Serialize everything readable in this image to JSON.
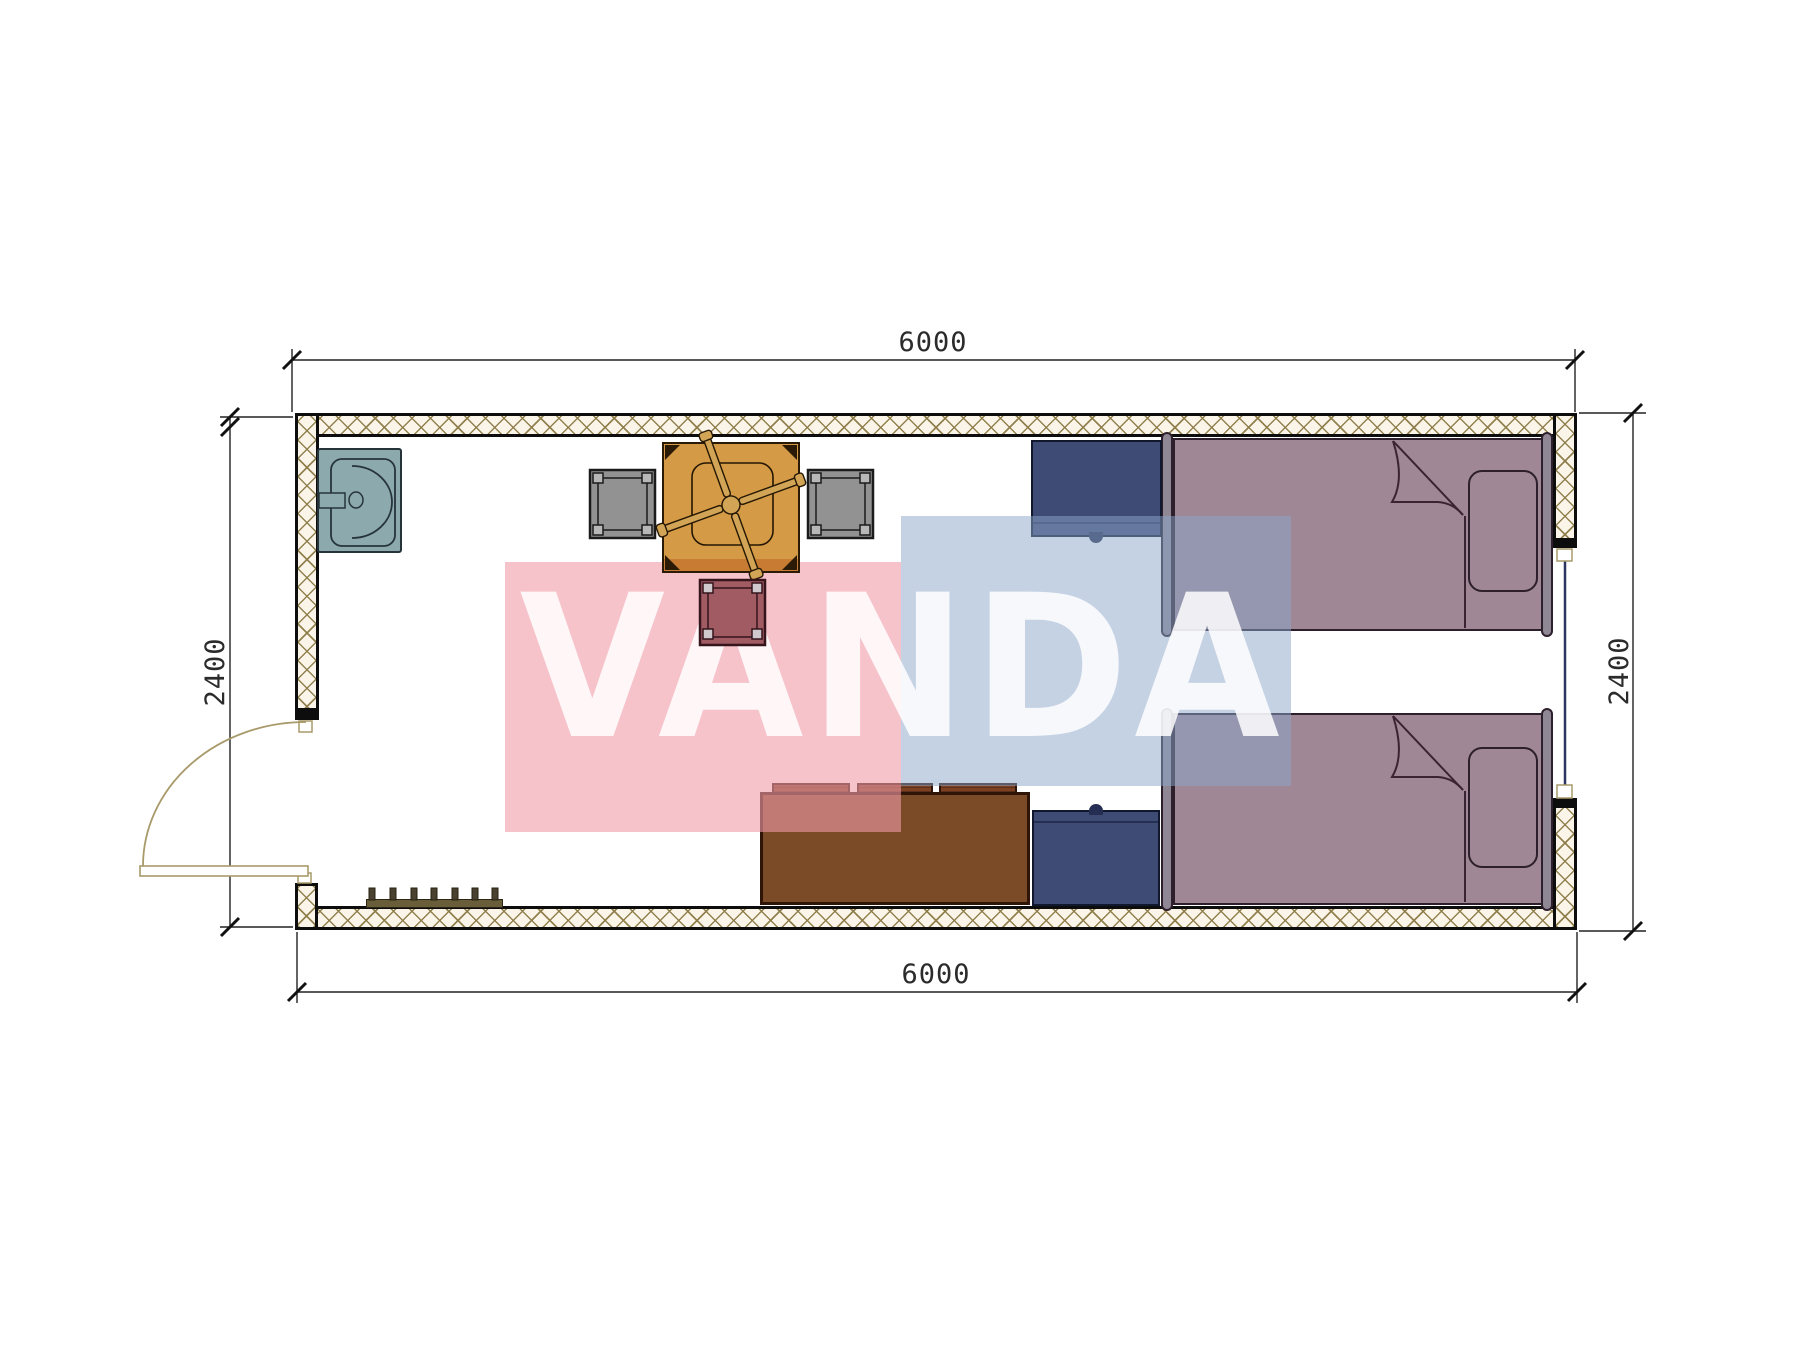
{
  "dimensions": {
    "top": "6000",
    "bottom": "6000",
    "left": "2400",
    "right": "2400"
  },
  "watermark": {
    "text": "VANDA",
    "pink": "#f29ba8",
    "blue": "#8ba5c9"
  },
  "colors": {
    "wall_outline": "#0d0d0d",
    "wall_hatch": "#8d7c48",
    "sink": "#8ca9ae",
    "table": "#d49a46",
    "stool_gray": "#929292",
    "stool_red": "#a15b63",
    "nightstand": "#3e4b74",
    "bed": "#9f8795",
    "sofa": "#7b4a27",
    "door_line": "#a89a6a",
    "dimension_line": "#222222"
  }
}
